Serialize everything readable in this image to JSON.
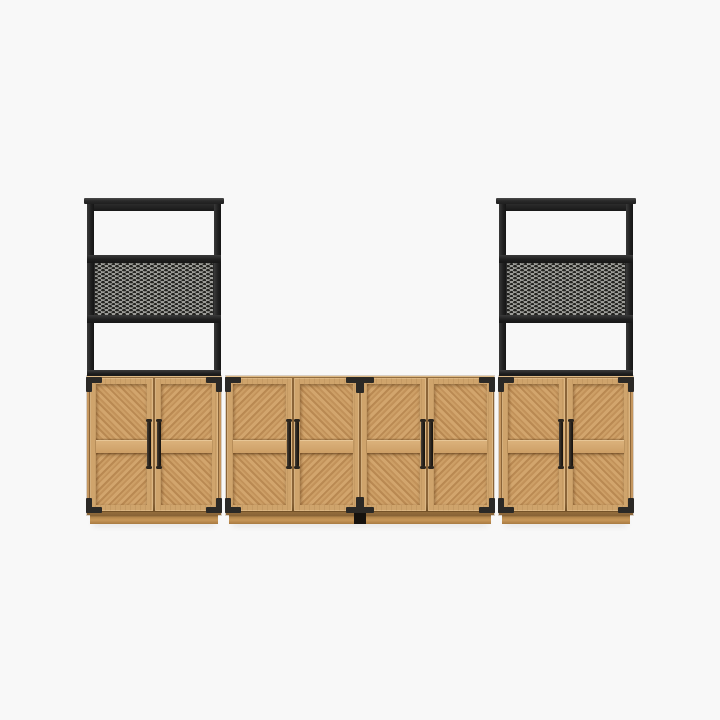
{
  "image": {
    "type": "product-photo",
    "description": "Three-piece modern farmhouse storage set on a plain white backdrop: a four-door light-oak media console flanked by two matching two-door oak cabinets, each topped with a black steel hutch that has an open upper shelf, a perforated-metal panel section, and an open lower section. Doors have framed chevron wood-grain panels, dark bronze vertical bar pulls, and black metal corner brackets.",
    "background_color": "#f8f8f8"
  },
  "colors": {
    "background": "#f8f8f8",
    "wood_base": "#c6975f",
    "wood_light": "#dcb37d",
    "wood_dark": "#a87a41",
    "metal_frame": "#212121",
    "mesh_base": "#9b9b97",
    "mesh_hole": "#232320",
    "hardware": "#2b2926",
    "handle": "#241f19"
  },
  "pieces": [
    {
      "id": "left-tower",
      "name": "storage cabinet with hutch",
      "doors": 2,
      "open_shelves": 2,
      "mesh_panels": 1,
      "handles": 2,
      "corner_brackets": 4
    },
    {
      "id": "center-console",
      "name": "four-door media console",
      "doors": 4,
      "handles": 4,
      "corner_brackets": 4,
      "center_brackets": 2
    },
    {
      "id": "right-tower",
      "name": "storage cabinet with hutch",
      "doors": 2,
      "open_shelves": 2,
      "mesh_panels": 1,
      "handles": 2,
      "corner_brackets": 4
    }
  ]
}
